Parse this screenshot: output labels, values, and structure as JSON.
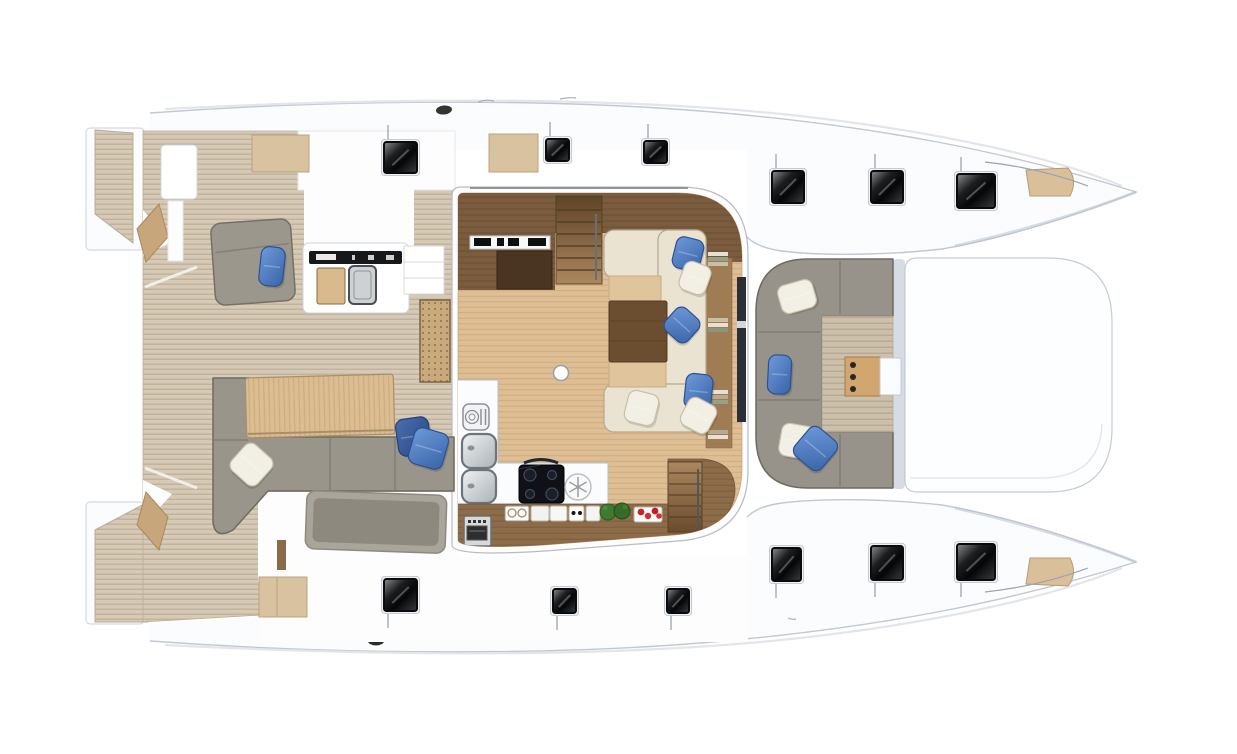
{
  "diagram": {
    "subject": "catamaran-deck-plan-top-view",
    "orientation": "bow-right",
    "palette": {
      "hull_white": "#fbfcfe",
      "hull_line": "#c2c8d1",
      "teak": "#d5c9b5",
      "teak_line": "#baac95",
      "salon_floor": "#debf95",
      "salon_floor_line": "#cfad7f",
      "dark_wood": "#7b5c3e",
      "mid_wood": "#8d6c4a",
      "sofa_gray": "#9a958b",
      "sofa_gray_line": "#6f6a61",
      "cushion_cream": "#ebe3d1",
      "cushion_tan": "#dfc49c",
      "pillow_blue": "#4a7dc3",
      "pillow_blue_dark": "#31559c",
      "pillow_white": "#f2efe4",
      "hatch_dark": "#0a0b0c",
      "appliance_black": "#0f1116",
      "plant_green": "#3f7a2e",
      "food_red": "#cc2222"
    },
    "regions": [
      {
        "id": "swim-platforms",
        "label": "stern swim platforms"
      },
      {
        "id": "aft-cockpit",
        "label": "aft cockpit teak deck"
      },
      {
        "id": "aft-sofa",
        "label": "aft cockpit L-sofa"
      },
      {
        "id": "aft-bench",
        "label": "aft cockpit bench"
      },
      {
        "id": "outdoor-galley",
        "label": "cockpit wet bar"
      },
      {
        "id": "salon",
        "label": "salon"
      },
      {
        "id": "nav-station",
        "label": "navigation station"
      },
      {
        "id": "galley",
        "label": "galley"
      },
      {
        "id": "dinette",
        "label": "dinette sofa and table"
      },
      {
        "id": "stairs",
        "label": "companionway stairs"
      },
      {
        "id": "forward-cockpit",
        "label": "forward cockpit lounge"
      },
      {
        "id": "foredeck",
        "label": "foredeck platform"
      },
      {
        "id": "bow-seats",
        "label": "bow seats"
      },
      {
        "id": "hatches",
        "label": "deck hatches"
      }
    ],
    "hatches": [
      {
        "x": 384,
        "y": 142,
        "w": 33,
        "h": 31,
        "tick": "up"
      },
      {
        "x": 546,
        "y": 139,
        "w": 23,
        "h": 22,
        "tick": "up"
      },
      {
        "x": 644,
        "y": 141,
        "w": 23,
        "h": 22,
        "tick": "up"
      },
      {
        "x": 772,
        "y": 171,
        "w": 32,
        "h": 32,
        "tick": "up"
      },
      {
        "x": 871,
        "y": 171,
        "w": 32,
        "h": 32,
        "tick": "up"
      },
      {
        "x": 957,
        "y": 174,
        "w": 38,
        "h": 34,
        "tick": "up"
      },
      {
        "x": 384,
        "y": 579,
        "w": 33,
        "h": 32,
        "tick": "down"
      },
      {
        "x": 553,
        "y": 589,
        "w": 23,
        "h": 24,
        "tick": "down"
      },
      {
        "x": 667,
        "y": 589,
        "w": 22,
        "h": 24,
        "tick": "down"
      },
      {
        "x": 772,
        "y": 548,
        "w": 29,
        "h": 33,
        "tick": "down"
      },
      {
        "x": 871,
        "y": 546,
        "w": 32,
        "h": 34,
        "tick": "down"
      },
      {
        "x": 957,
        "y": 544,
        "w": 38,
        "h": 36,
        "tick": "down"
      }
    ],
    "pillows": [
      {
        "x": 674,
        "y": 238,
        "w": 28,
        "h": 32,
        "rot": 14,
        "c": "blue"
      },
      {
        "x": 681,
        "y": 263,
        "w": 28,
        "h": 30,
        "rot": 20,
        "c": "white"
      },
      {
        "x": 667,
        "y": 310,
        "w": 30,
        "h": 30,
        "rot": 42,
        "c": "blue"
      },
      {
        "x": 685,
        "y": 374,
        "w": 27,
        "h": 35,
        "rot": 6,
        "c": "blue"
      },
      {
        "x": 683,
        "y": 400,
        "w": 31,
        "h": 31,
        "rot": 28,
        "c": "white"
      },
      {
        "x": 626,
        "y": 392,
        "w": 31,
        "h": 32,
        "rot": 14,
        "c": "white"
      },
      {
        "x": 260,
        "y": 247,
        "w": 24,
        "h": 39,
        "rot": 6,
        "c": "blue"
      },
      {
        "x": 234,
        "y": 447,
        "w": 35,
        "h": 35,
        "rot": 42,
        "c": "white"
      },
      {
        "x": 397,
        "y": 418,
        "w": 33,
        "h": 37,
        "rot": -8,
        "c": "blue_dark"
      },
      {
        "x": 411,
        "y": 430,
        "w": 35,
        "h": 37,
        "rot": 16,
        "c": "blue"
      },
      {
        "x": 779,
        "y": 282,
        "w": 36,
        "h": 29,
        "rot": -16,
        "c": "white"
      },
      {
        "x": 768,
        "y": 355,
        "w": 23,
        "h": 39,
        "rot": 3,
        "c": "blue"
      },
      {
        "x": 780,
        "y": 425,
        "w": 37,
        "h": 33,
        "rot": 10,
        "c": "white"
      },
      {
        "x": 798,
        "y": 430,
        "w": 35,
        "h": 37,
        "rot": 40,
        "c": "blue"
      }
    ]
  }
}
